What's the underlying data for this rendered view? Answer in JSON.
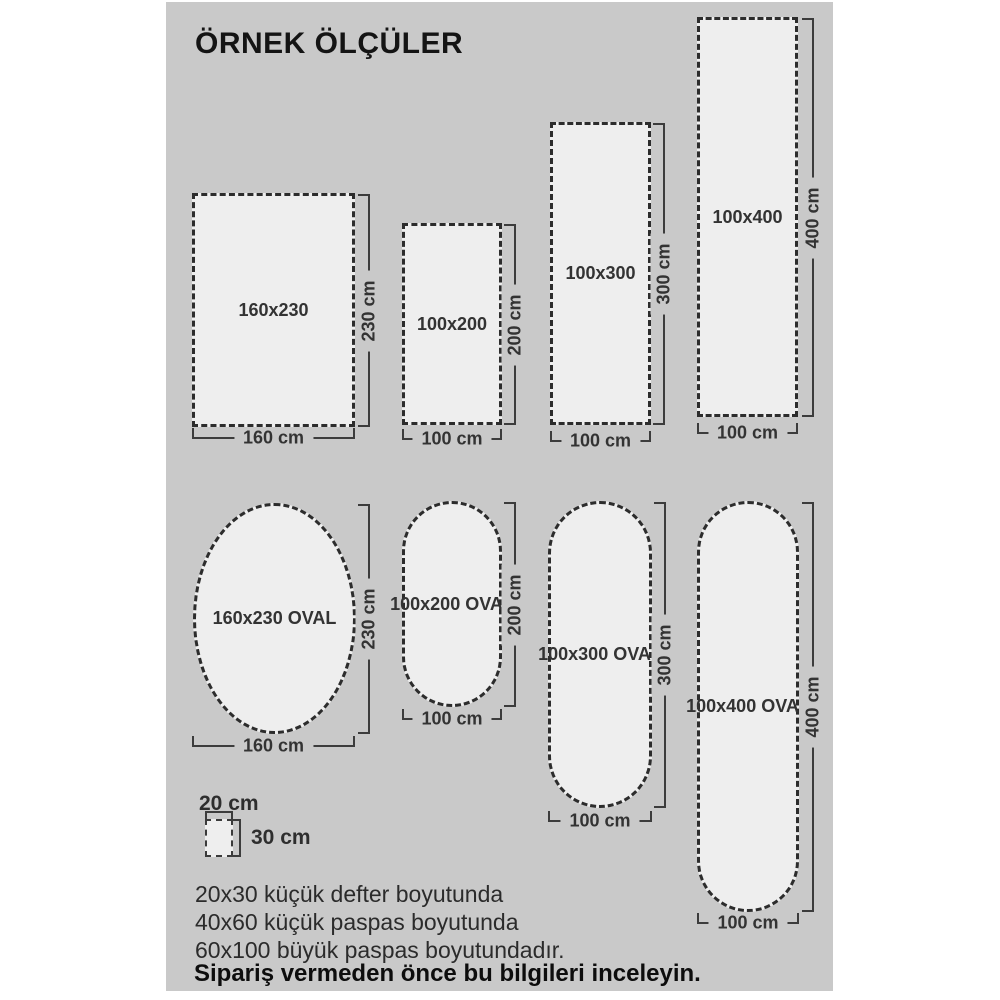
{
  "title": "ÖRNEK ÖLÇÜLER",
  "rects": [
    {
      "label": "160x230",
      "width_label": "160 cm",
      "height_label": "230 cm"
    },
    {
      "label": "100x200",
      "width_label": "100 cm",
      "height_label": "200 cm"
    },
    {
      "label": "100x300",
      "width_label": "100 cm",
      "height_label": "300 cm"
    },
    {
      "label": "100x400",
      "width_label": "100 cm",
      "height_label": "400 cm"
    }
  ],
  "ovals": [
    {
      "label": "160x230 OVAL",
      "width_label": "160 cm",
      "height_label": "230 cm"
    },
    {
      "label": "100x200 OVAL",
      "width_label": "100 cm",
      "height_label": "200 cm"
    },
    {
      "label": "100x300 OVAL",
      "width_label": "100 cm",
      "height_label": "300 cm"
    },
    {
      "label": "100x400 OVAL",
      "width_label": "100 cm",
      "height_label": "400 cm"
    }
  ],
  "reference": {
    "width_label": "20 cm",
    "height_label": "30 cm"
  },
  "notes": [
    "20x30 küçük defter boyutunda",
    "40x60 küçük paspas boyutunda",
    "60x100 büyük paspas boyutundadır."
  ],
  "warning": "Sipariş vermeden önce bu bilgileri inceleyin.",
  "colors": {
    "canvas": "#c9c9c9",
    "shape_fill": "#eeeeee",
    "dash": "#2c2c2c",
    "line": "#3c3c3c",
    "text": "#333333"
  }
}
